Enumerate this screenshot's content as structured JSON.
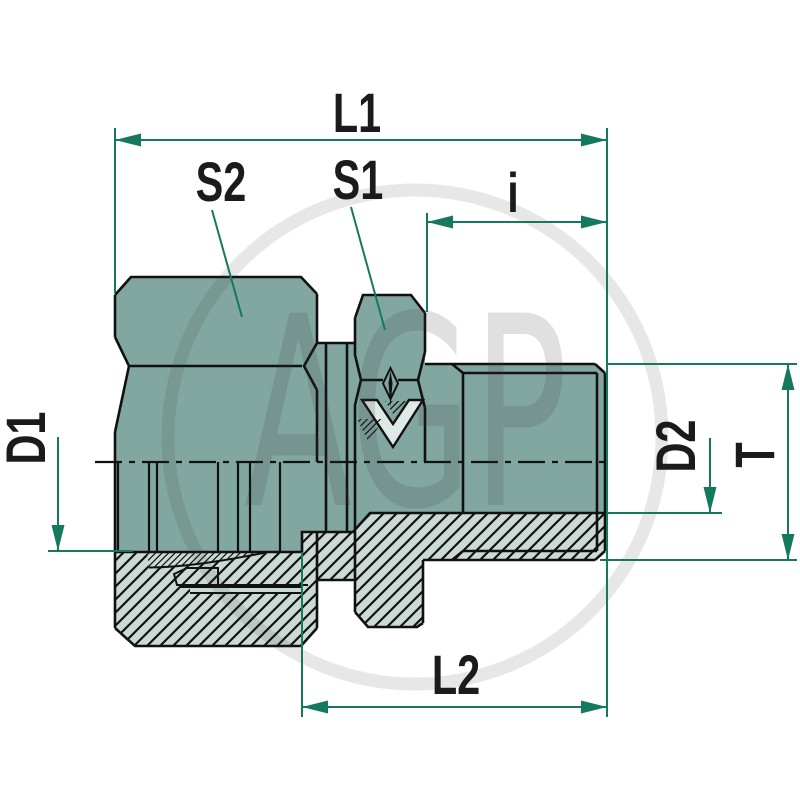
{
  "labels": {
    "l1": "L1",
    "s2": "S2",
    "s1": "S1",
    "i": "i",
    "d1": "D1",
    "d2": "D2",
    "t": "T",
    "l2": "L2"
  },
  "watermark": {
    "text": "AGP"
  },
  "colors": {
    "dimension": "#15795e",
    "body": "#82a7a0",
    "section_fill": "#ccdad6",
    "line": "#111111",
    "label_text": "#1b1b1b",
    "background": "#ffffff"
  }
}
